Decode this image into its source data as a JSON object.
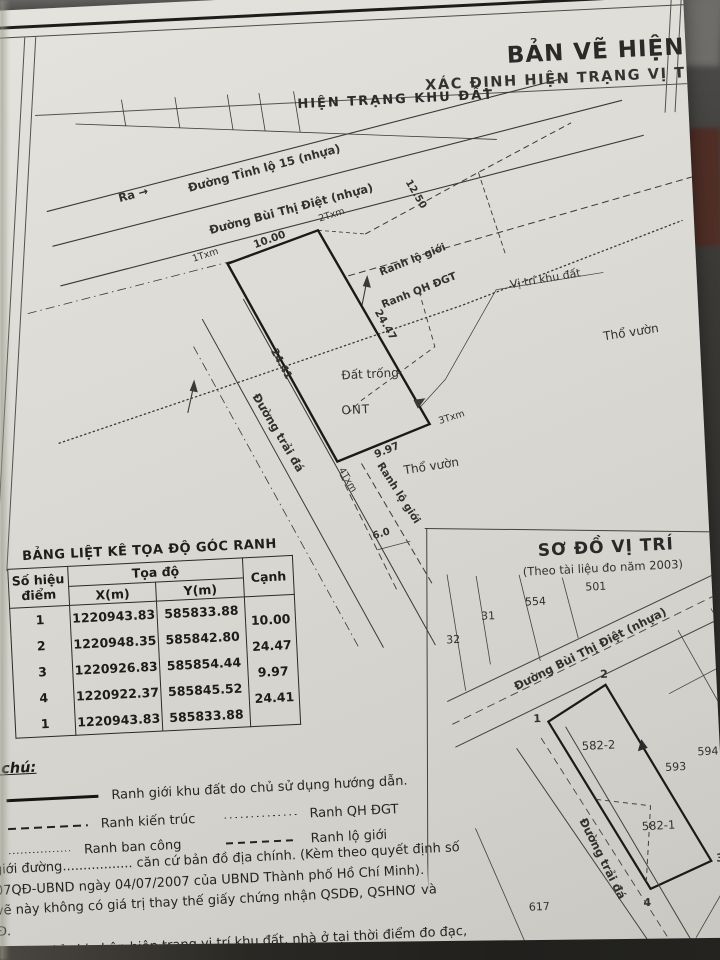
{
  "header": {
    "title_line1": "BẢN VẼ HIỆN",
    "title_line2": "XÁC ĐỊNH HIỆN TRẠNG VỊ T"
  },
  "site_plan": {
    "title": "HIỆN TRẠNG KHU ĐẤT",
    "ra_label": "Ra →",
    "road_tinh_lo_15": "Đường Tỉnh lộ 15 (nhựa)",
    "road_bui_thi_diet": "Đường Bùi Thị Điệt (nhựa)",
    "road_trai_da": "Đường trải đá",
    "ranh_lo_gioi_top": "Ranh lộ giới",
    "ranh_qh_dgt": "Ranh QH ĐGT",
    "vi_tri_khu_dat": "Vị trí khu đất",
    "tho_vuon_right": "Thổ vườn",
    "tho_vuon_bottom": "Thổ vườn",
    "dat_trong": "Đất trống",
    "ont": "ONT",
    "ranh_lo_gioi_bottom": "Ranh lộ giới",
    "corner_1": "1Txm",
    "corner_2": "2Txm",
    "corner_3": "3Txm",
    "corner_4": "4Txm",
    "dim_top": "10.00",
    "dim_right": "24.47",
    "dim_bottom": "9.97",
    "dim_left": "24.41",
    "dim_setback": "12.50",
    "dim_road": "6.0"
  },
  "coords_table": {
    "title": "BẢNG LIỆT KÊ TỌA ĐỘ GÓC RANH",
    "col_point_line1": "Số hiệu",
    "col_point_line2": "điểm",
    "col_coord": "Tọa độ",
    "col_x": "X(m)",
    "col_y": "Y(m)",
    "col_edge": "Cạnh",
    "rows": [
      {
        "id": "1",
        "x": "1220943.83",
        "y": "585833.88"
      },
      {
        "id": "2",
        "x": "1220948.35",
        "y": "585842.80"
      },
      {
        "id": "3",
        "x": "1220926.83",
        "y": "585854.44"
      },
      {
        "id": "4",
        "x": "1220922.37",
        "y": "585845.52"
      },
      {
        "id": "1",
        "x": "1220943.83",
        "y": "585833.88"
      }
    ],
    "edges": [
      "10.00",
      "24.47",
      "9.97",
      "24.41"
    ]
  },
  "legend": {
    "heading": "Ghi chú:",
    "item_boundary": "Ranh giới khu đất do chủ sử dụng hướng dẫn.",
    "item_kien_truc": "Ranh kiến trúc",
    "item_qh_dgt": "Ranh QH ĐGT",
    "item_ban_cong": "Ranh ban công",
    "item_lo_gioi": "Ranh lộ giới"
  },
  "notes": {
    "line1": "giới đường................. căn cứ bản đồ địa chính. (Kèm theo quyết định số",
    "line2": "07QĐ-UBND ngày 04/07/2007 của UBND Thành phố Hồ Chí Minh).",
    "line3": "vẽ này không có giá trị thay thế giấy chứng nhận QSDĐ, QSHNƠ và",
    "line4": "Đ.",
    "line5": "vẽ này chỉ ghi nhận hiện trạng vị trí khu đất, nhà ở tại thời điểm đo đạc, khi",
    "line6": "ử dụng đất thực hiện đăng ký cấn giấy chừng"
  },
  "location_map": {
    "title": "SƠ ĐỒ VỊ TRÍ",
    "subtitle": "(Theo tài liệu đo năm 2003)",
    "street": "Đường Bùi Thị Điệt (nhựa)",
    "road_trai_da": "Đường trải đá",
    "parcel_501": "501",
    "parcel_554": "554",
    "parcel_31": "31",
    "parcel_32": "32",
    "parcel_582_2": "582-2",
    "parcel_582_1": "582-1",
    "parcel_593": "593",
    "parcel_594": "594",
    "parcel_617": "617",
    "corner_1": "1",
    "corner_2": "2",
    "corner_3": "3",
    "corner_4": "4"
  },
  "colors": {
    "paper": "#dcdad4",
    "ink": "#2e2d2b",
    "background": "#35332f",
    "accent_maroon": "#4f2e26"
  }
}
